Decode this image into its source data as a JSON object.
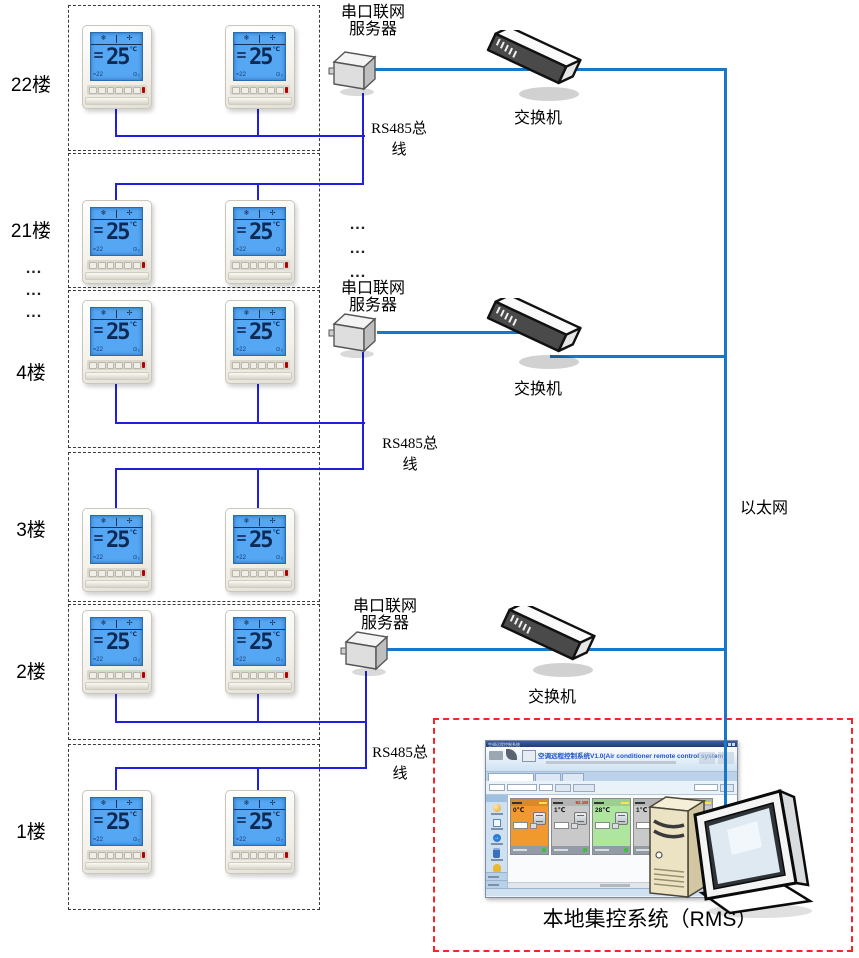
{
  "diagram": {
    "floors": [
      {
        "label": "22楼"
      },
      {
        "label": "21楼"
      },
      {
        "label": "4楼"
      },
      {
        "label": "3楼"
      },
      {
        "label": "2楼"
      },
      {
        "label": "1楼"
      }
    ],
    "thermostat": {
      "temp": "25",
      "unit": "℃",
      "lcd_bottom_left": "≈22",
      "lcd_bottom_right": "⊙₂"
    },
    "server_label": [
      "串口联网",
      "服务器"
    ],
    "switch_label": "交换机",
    "rs485_label": [
      "RS485总",
      "线"
    ],
    "ethernet_label": "以太网",
    "ellipsis": "...",
    "rms_label": "本地集控系统（RMS）"
  },
  "software": {
    "titlebar": "空调远程控制系统",
    "title": "空调远程控制系统V1.0(Air conditioner remote control system)",
    "cards": [
      {
        "color": "#f2992e",
        "temp": "0℃",
        "badge": ""
      },
      {
        "color": "#c9c9c9",
        "temp": "1℃",
        "badge": "92.1M"
      },
      {
        "color": "#aee6a0",
        "temp": "28℃",
        "badge": ""
      },
      {
        "color": "#c9c9c9",
        "temp": "1℃",
        "badge": "10.4M"
      },
      {
        "color": "#c9c9c9",
        "temp": "7℃",
        "badge": ""
      }
    ]
  },
  "colors": {
    "rs485": "#1f1fdd",
    "ethernet": "#1878c8",
    "floor_box": "#3a3a3a",
    "rms_box": "#ff2222",
    "badge_red": "#c82000"
  }
}
